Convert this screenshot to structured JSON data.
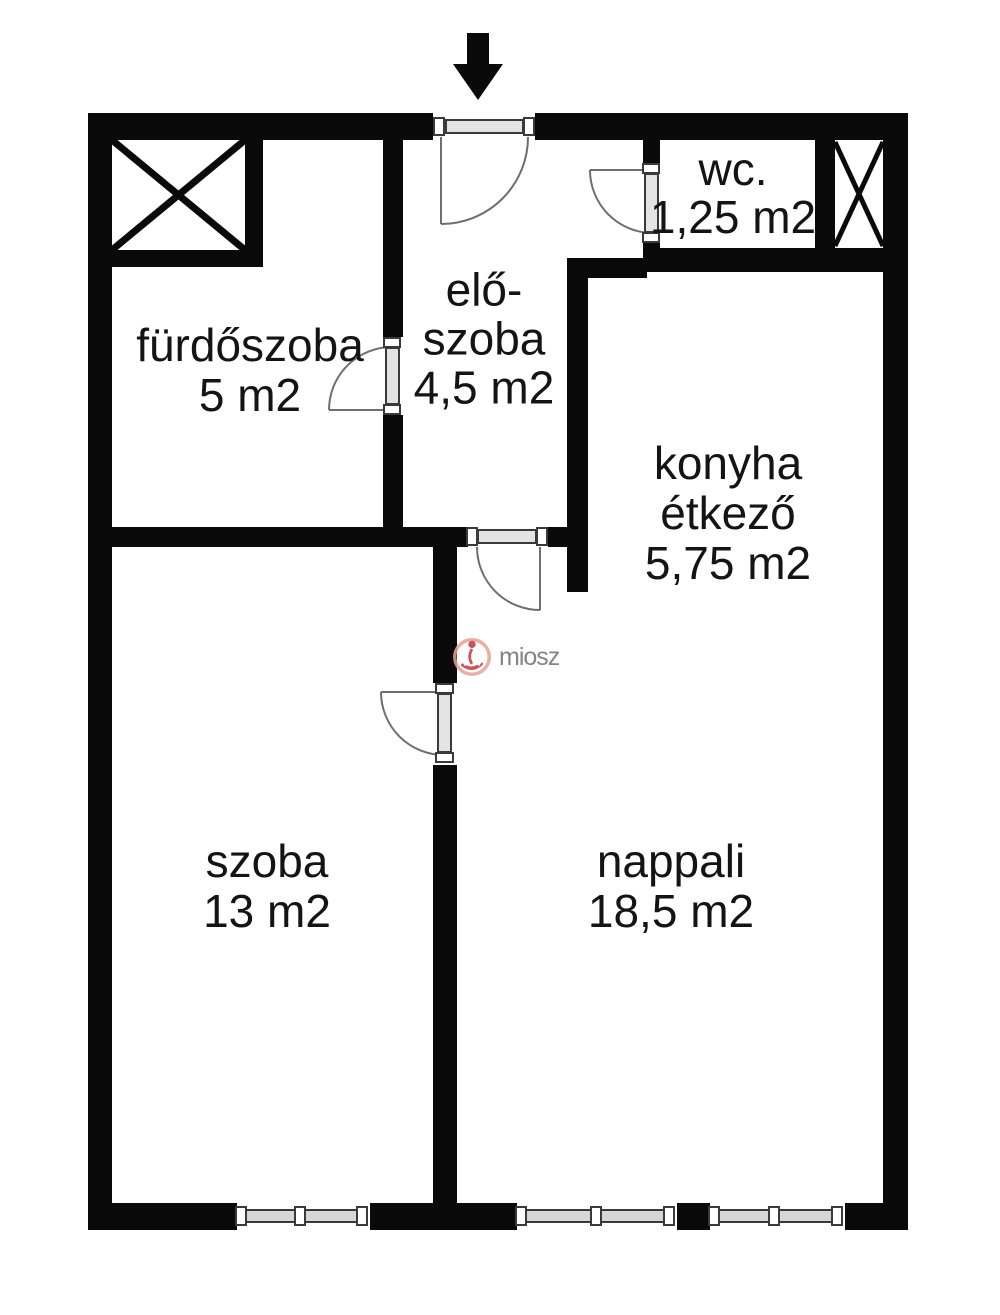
{
  "rooms": [
    {
      "id": "furdoszoba",
      "lines": [
        "fürdőszoba",
        "5 m2"
      ]
    },
    {
      "id": "eloszoba",
      "lines": [
        "elő-",
        "szoba",
        "4,5 m2"
      ]
    },
    {
      "id": "wc",
      "lines": [
        "wc.",
        "1,25 m2"
      ]
    },
    {
      "id": "konyha",
      "lines": [
        "konyha",
        "étkező",
        "5,75 m2"
      ]
    },
    {
      "id": "szoba",
      "lines": [
        "szoba",
        "13 m2"
      ]
    },
    {
      "id": "nappali",
      "lines": [
        "nappali",
        "18,5 m2"
      ]
    }
  ],
  "watermark": {
    "text": "miosz"
  },
  "colors": {
    "wall": "#0a0a0a",
    "door_line": "#6e6e6e",
    "threshold_fill": "#e3e3e3",
    "window_fill": "#d6d6d6",
    "watermark_text": "#6f6f6f",
    "watermark_salmon": "#e8a097",
    "watermark_red": "#c4373c"
  }
}
